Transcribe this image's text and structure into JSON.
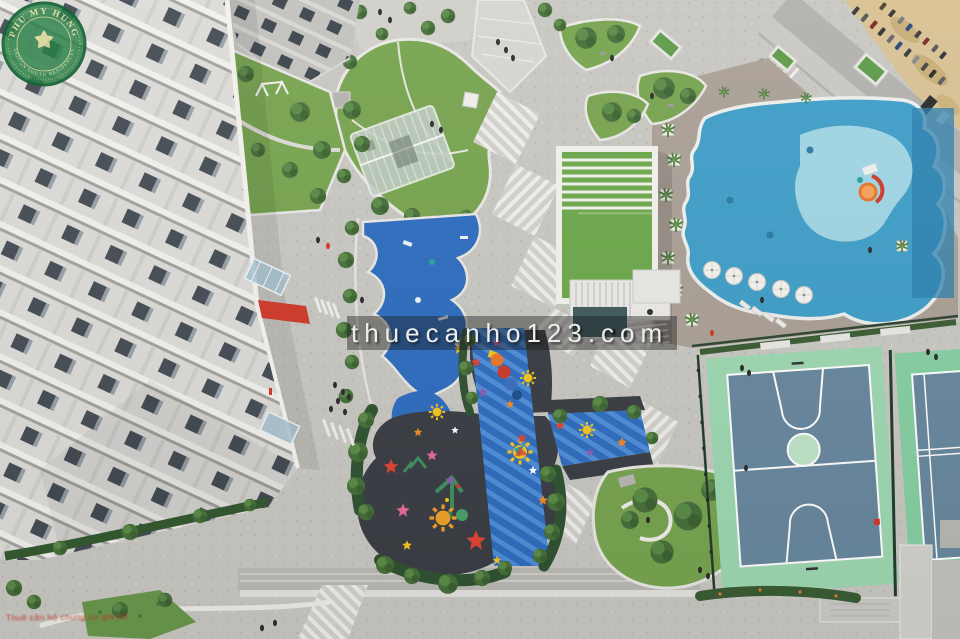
{
  "image_alt": "Aerial view of an apartment complex courtyard with swimming pool, children playground, basketball and tennis courts, lawns and walkways",
  "watermark": {
    "text": "thuecanho123.com",
    "band_color": "rgba(22,22,22,0.42)",
    "text_color": "#f3f3f1"
  },
  "logo": {
    "arc_top": "PHU MY HUNG",
    "arc_bottom": "SAIGON SOUTH RESIDENCES",
    "fill_color": "#1d7a3e",
    "ring_color": "#0d5c2c",
    "text_color": "#e6dfa0"
  },
  "fine_print": {
    "text": "Thuê căn hộ chung cư giá tốt",
    "color": "#c32d20"
  },
  "scene": {
    "tower": "apartment-tower",
    "pool": "swimming-pool",
    "kids_pool": "kids-pool",
    "clubhouse": "clubhouse-green-roof",
    "playground": "children-playground",
    "fitness": "blue-fitness-area",
    "basketball": "basketball-court",
    "tennis": "tennis-court",
    "park": "central-lawn",
    "road": "street-with-motorbikes",
    "sand": "construction-sand-lot"
  },
  "colors": {
    "paving": "#c8c7c2",
    "facade": "#dcdbd7",
    "window": "#454c54",
    "lawn": "#77a44f",
    "lawn_dark": "#6a974c",
    "tree": "#466f39",
    "hedge": "#2f5231",
    "pool_blue": "#3f9ec8",
    "pool_deep": "#2b7fae",
    "kids_pool": "#a5d8e6",
    "deck": "#aaa096",
    "turf_roof": "#6ca84b",
    "playground_asphalt": "#3a3e44",
    "playground_blue": "#2e6dbf",
    "playground_blue_light": "#4f8ed8",
    "sun_yellow": "#f4c520",
    "star_red": "#e04433",
    "star_orange": "#f08a28",
    "star_purple": "#8a5fb0",
    "star_pink": "#e56a9a",
    "court_apron": "#9ed8b2",
    "court_surface": "#68879e",
    "court_line": "#ffffff",
    "sand": "#d8c193",
    "road": "#b2b1ad",
    "red_accent": "#cf3a2a",
    "glass": "#a9c3cd"
  }
}
